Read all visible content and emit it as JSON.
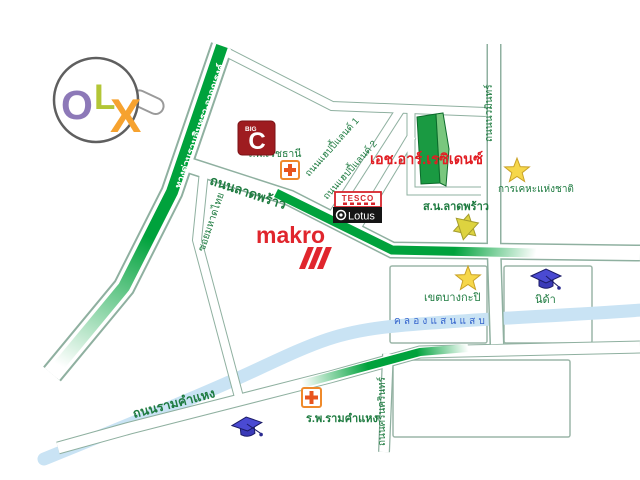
{
  "brand": {
    "name": "OLX",
    "letters": {
      "o": "O",
      "l": "L",
      "x": "X"
    },
    "colors": {
      "o": "#8d79b8",
      "l": "#b3c636",
      "x": "#f6a22f"
    }
  },
  "map": {
    "roads": {
      "expressway": "ทางด่วนรามอินทรา-อาจณรงค์",
      "ladprao": "ถนนลาดพร้าว",
      "soi_mahat_thai": "ซอยมหาดไทย",
      "happyland1": "ถนนแฮปปี้แลนด์ 1",
      "happyland2": "ถนนแฮปปี้แลนด์ 2",
      "nawamin": "ถนนนวมินทร์",
      "ramkhamhaeng": "ถนนรามคำแหง",
      "srinakarin": "ถนนศรีนครินทร์"
    },
    "canal": {
      "name": "คลองแสนแสบ"
    },
    "places": {
      "hr_residence": "เอช.อาร์.เรซิเดนซ์",
      "vejthani_hospital": "ร.พ.เวชธานี",
      "ramkhamhaeng_hospital": "ร.พ.รามคำแหง",
      "police_station": "ส.น.ลาดพร้าว",
      "national_housing": "การเคหะแห่งชาติ",
      "bangkapi_district": "เขตบางกะปิ",
      "nida": "นิด้า",
      "makro": "makro",
      "bigc": {
        "big": "BIG",
        "c": "C"
      },
      "tesco": "TESCO",
      "lotus": "Lotus"
    },
    "colors": {
      "road_green": "#00a23c",
      "label_green": "#1e7b40",
      "landmark_red": "#e21d23",
      "canal_blue": "#c9e3f4",
      "canal_text_blue": "#3565cd",
      "star_yellow": "#f6d74a",
      "cap_blue": "#4a4ad2",
      "bigc_red": "#9e1c20"
    }
  }
}
